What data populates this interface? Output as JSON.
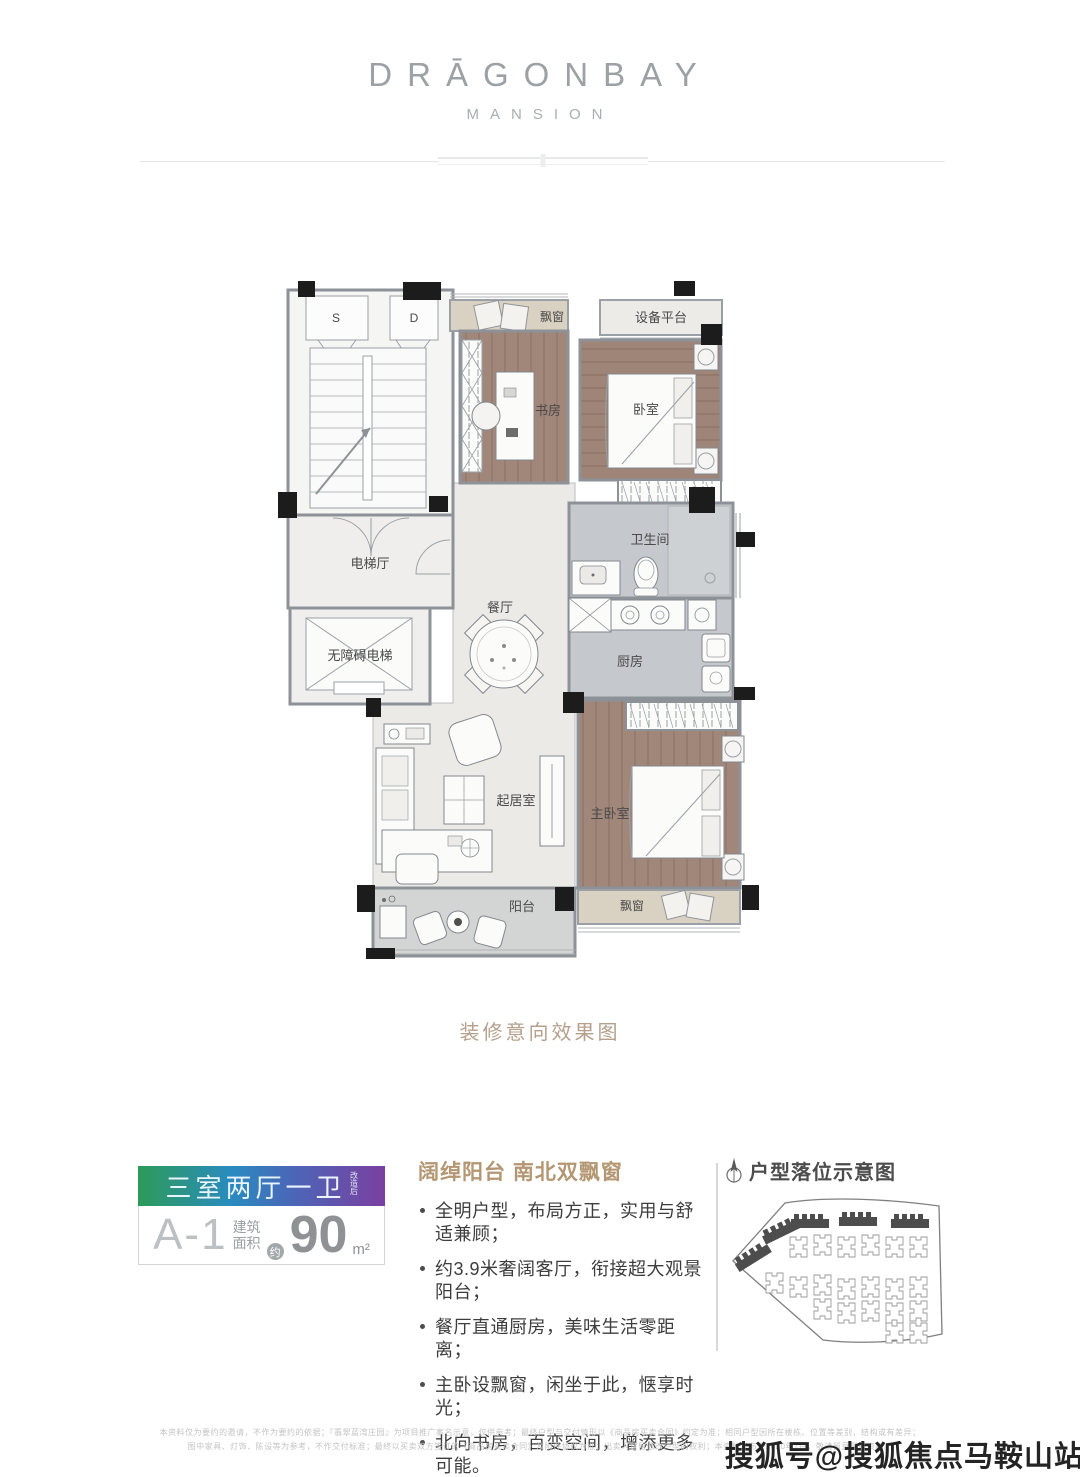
{
  "brand": {
    "name": "DRĀGONBAY",
    "subtitle": "MANSION"
  },
  "floorplan": {
    "caption": "装修意向效果图",
    "rooms": {
      "stair_s": "S",
      "stair_d": "D",
      "stair_up": "上",
      "stair_down": "下",
      "elevator_hall": "电梯厅",
      "accessible_elevator": "无障碍电梯",
      "bay_window_top": "飘窗",
      "equipment_platform": "设备平台",
      "study": "书房",
      "bedroom": "卧室",
      "bathroom": "卫生间",
      "kitchen": "厨房",
      "dining": "餐厅",
      "living": "起居室",
      "master_bedroom": "主卧室",
      "balcony": "阳台",
      "bay_window_bottom": "飘窗"
    }
  },
  "unit_card": {
    "layout": "三室两厅一卫",
    "layout_note": "改造后",
    "unit_code": "A-1",
    "area_label_line1": "建筑",
    "area_label_line2": "面积",
    "area_approx": "约",
    "area_value": "90",
    "area_unit": "m²",
    "gradient": [
      "#2c9b58",
      "#2a8bc0",
      "#7b3fa0"
    ]
  },
  "highlights": {
    "title": "阔绰阳台 南北双飘窗",
    "items": [
      "全明户型，布局方正，实用与舒适兼顾；",
      "约3.9米奢阔客厅，衔接超大观景阳台；",
      "餐厅直通厨房，美味生活零距离；",
      "主卧设飘窗，闲坐于此，惬享时光；",
      "北向书房，百变空间，增添更多可能。"
    ]
  },
  "location_panel": {
    "title": "户型落位示意图"
  },
  "disclaimer": {
    "line1": "本资料仅为要约的邀请，不作为要约的依据；『翡翠蓝湾庄园』为项目推广案名示意，仅供参考；最终户型与交付情形以《商品房买卖合同》约定为准；相同户型因所在楼栋、位置等差别，结构或有差异；",
    "line2": "图中家具、灯饰、陈设等为参考，不作交付标准；最终以买卖双方签订的《商品房买卖合同》及附件协议为准；出卖人保留修改户型的权利；本资料发布于2020年7月，敬请留意最新资料。"
  },
  "watermark": "搜狐号@搜狐焦点马鞍山站"
}
